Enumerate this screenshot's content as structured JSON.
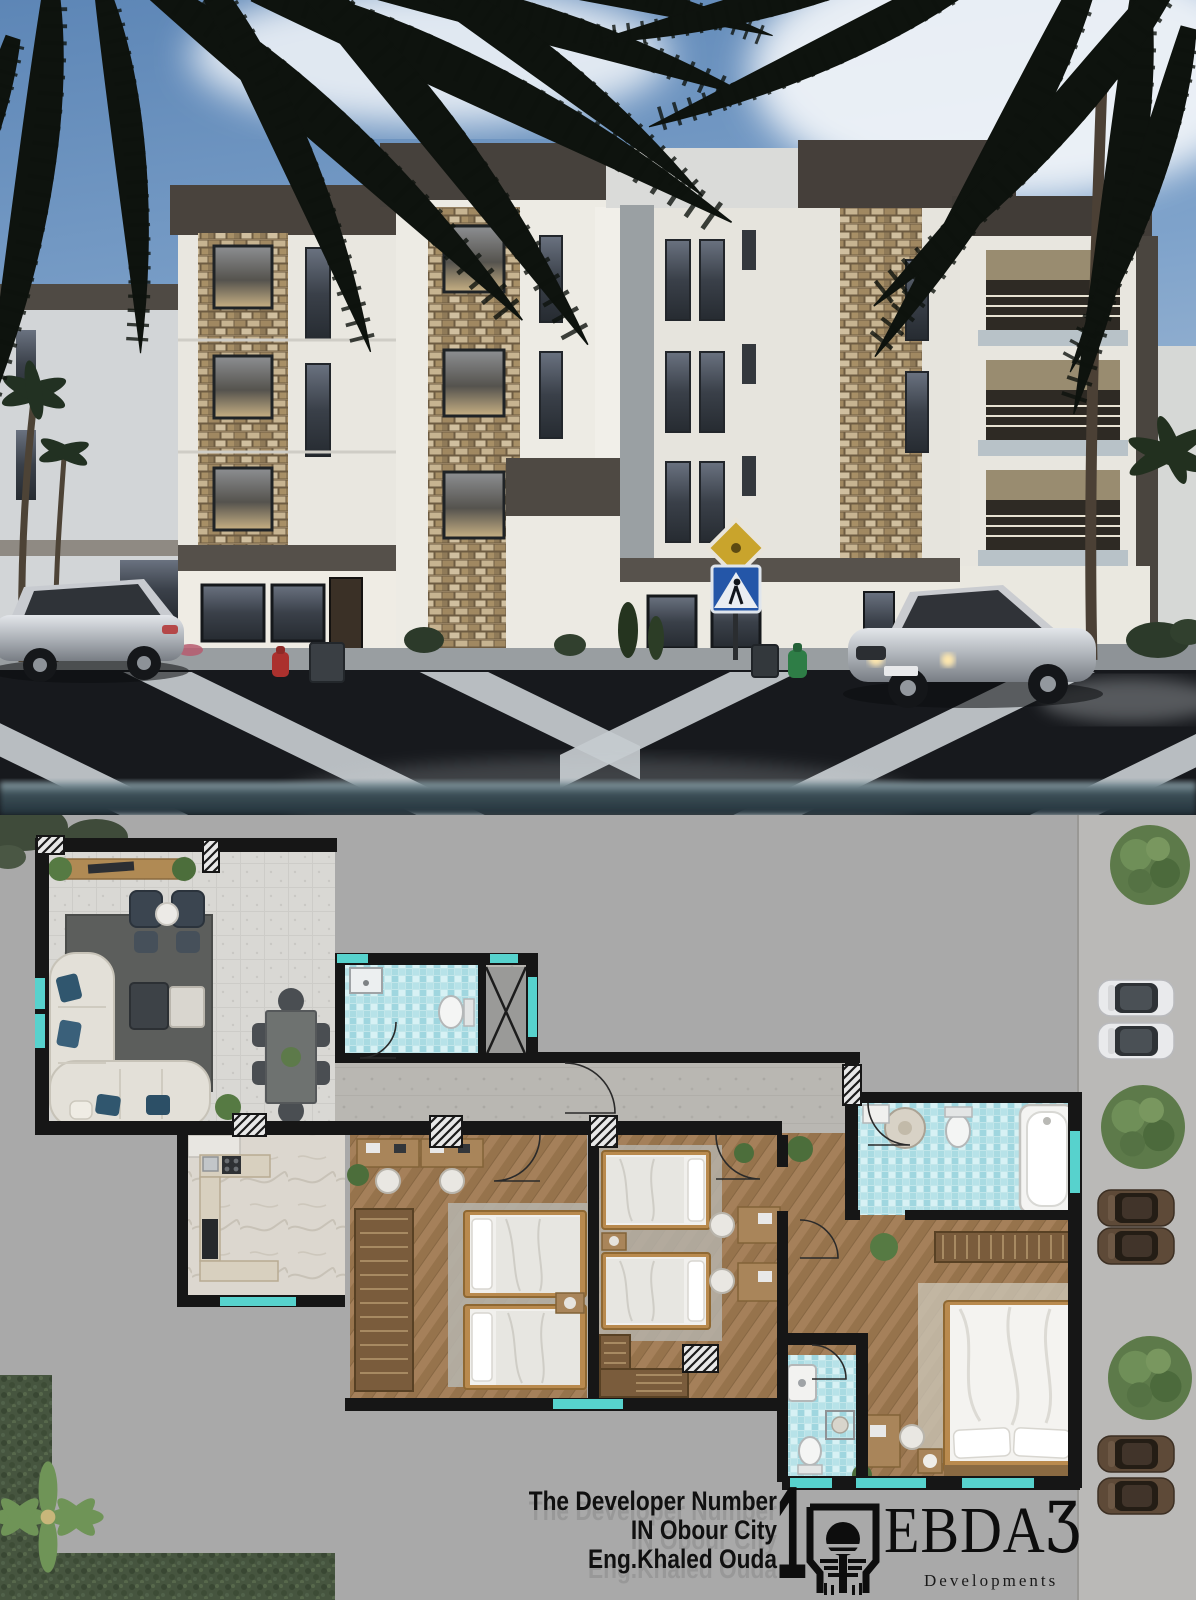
{
  "caption": {
    "line1": "The Developer Number",
    "line2": "IN Obour City",
    "line3": "Eng.Khaled Ouda",
    "numeral": "1"
  },
  "brand": {
    "wordmark": "EBDA",
    "glyph": "Ʒ",
    "tagline": "Developments",
    "emblem": "sunset-over-water-in-square-frame"
  },
  "palette": {
    "plan_background": "#a9a9a9",
    "road_strip": "#bab9b7",
    "wall_black": "#161616",
    "window_cyan": "#57d2cd",
    "bath_tile_blue": "#bfe4e9",
    "wood_floor": "#a07c52",
    "living_floor": "#d9d8d4",
    "marble_floor": "#dcd7cf",
    "hedge_green": "#46553f",
    "sky_blue": "#6d93c2",
    "facade_white": "#eae8e1",
    "parapet_dark": "#48423c",
    "stone_tan": "#b9a27e",
    "asphalt": "#17191d"
  },
  "scene": {
    "building": "four-storey modern apartment block at dusk",
    "street_trees": 3,
    "parked_cars_right": [
      "white",
      "white",
      "brown",
      "brown",
      "brown",
      "brown"
    ],
    "moving_cars": [
      "silver sedan",
      "silver sports coupe"
    ],
    "road_signs": [
      "yellow priority diamond",
      "blue pedestrian crossing"
    ],
    "hydrants": [
      "red",
      "green"
    ]
  },
  "floor_plan": {
    "rooms": [
      "living room",
      "dining area",
      "guest bathroom",
      "duct shaft",
      "corridor",
      "kitchen",
      "kids bedroom 1",
      "kids bedroom 2",
      "master hallway",
      "master bathroom",
      "master bedroom",
      "second bathroom"
    ]
  }
}
